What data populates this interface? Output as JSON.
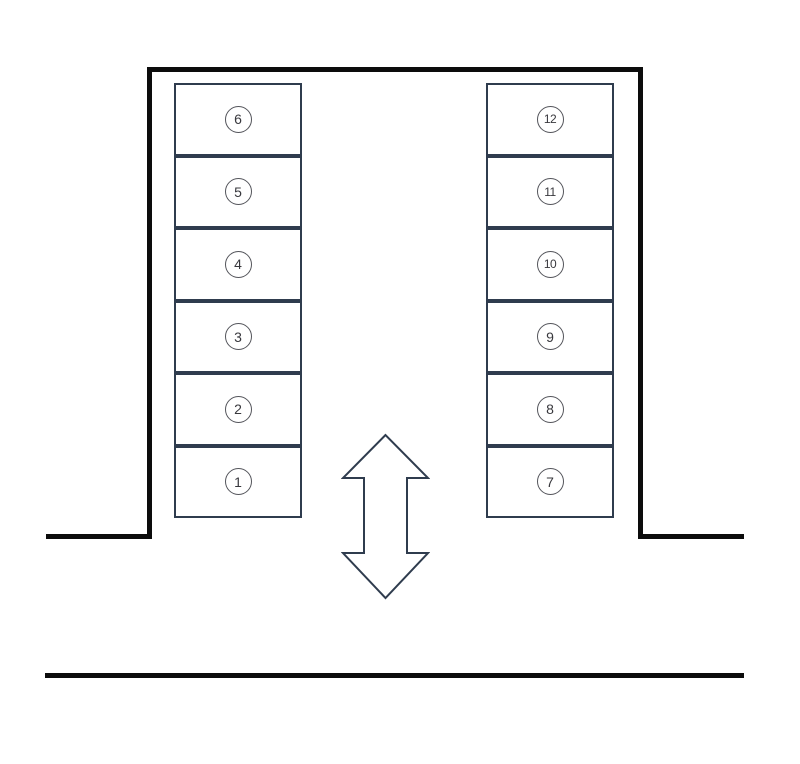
{
  "colors": {
    "background": "#ffffff",
    "wall": "#0c0c0c",
    "stall_border": "#2f3c4e",
    "arrow_outline": "#2f3c4e",
    "circle_border": "#54555b",
    "number_color": "#38383d"
  },
  "parking": {
    "left_column": [
      "6",
      "5",
      "4",
      "3",
      "2",
      "1"
    ],
    "right_column": [
      "12",
      "11",
      "10",
      "9",
      "8",
      "7"
    ]
  },
  "icons": {
    "two_way_arrow": "↕"
  }
}
